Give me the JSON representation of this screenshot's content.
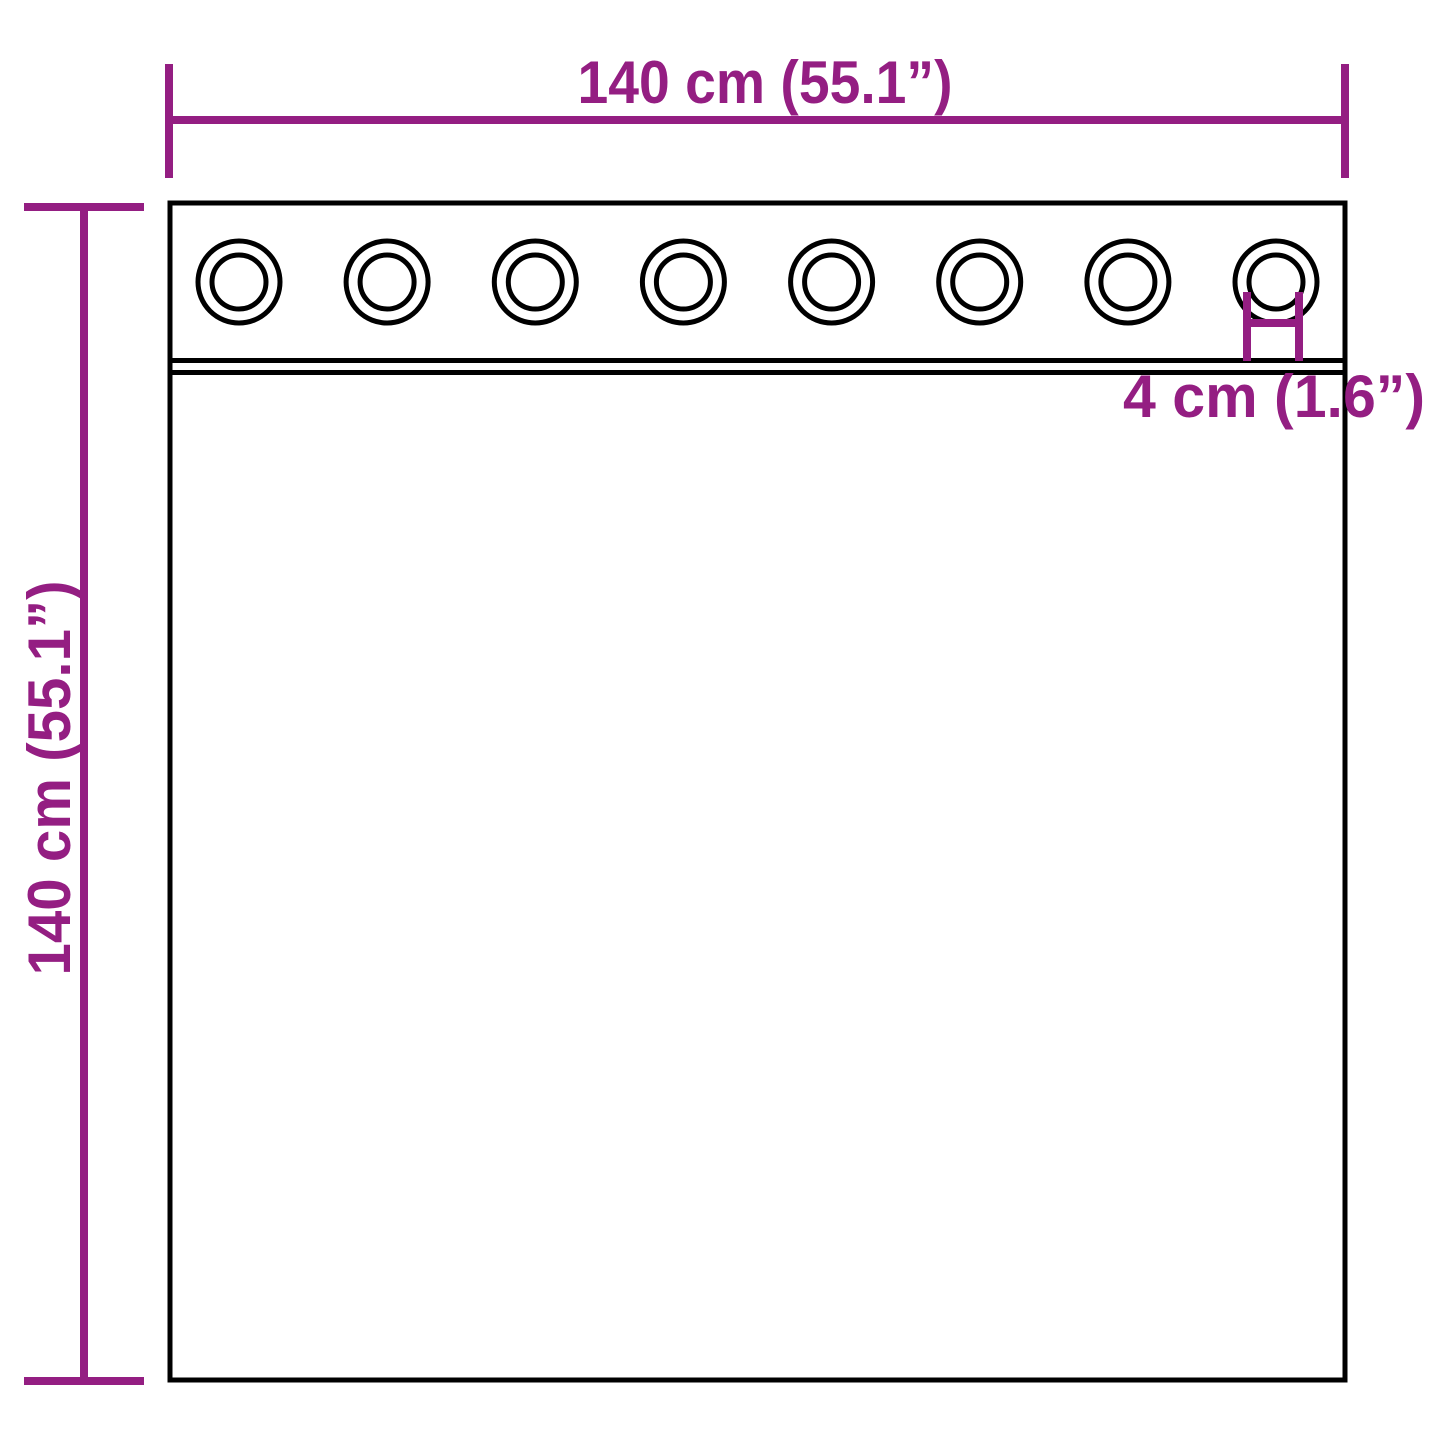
{
  "diagram": {
    "type": "product-dimension-diagram",
    "subject": "curtain-with-grommets",
    "width_label": "140 cm (55.1”)",
    "height_label": "140 cm (55.1”)",
    "grommet_label": "4 cm (1.6”)",
    "grommet_count": 8,
    "values": {
      "width_cm": 140,
      "width_in": 55.1,
      "height_cm": 140,
      "height_in": 55.1,
      "grommet_diameter_cm": 4,
      "grommet_diameter_in": 1.6
    }
  },
  "colors": {
    "dimension_accent": "#941e82",
    "outline": "#000000",
    "background": "#ffffff"
  }
}
